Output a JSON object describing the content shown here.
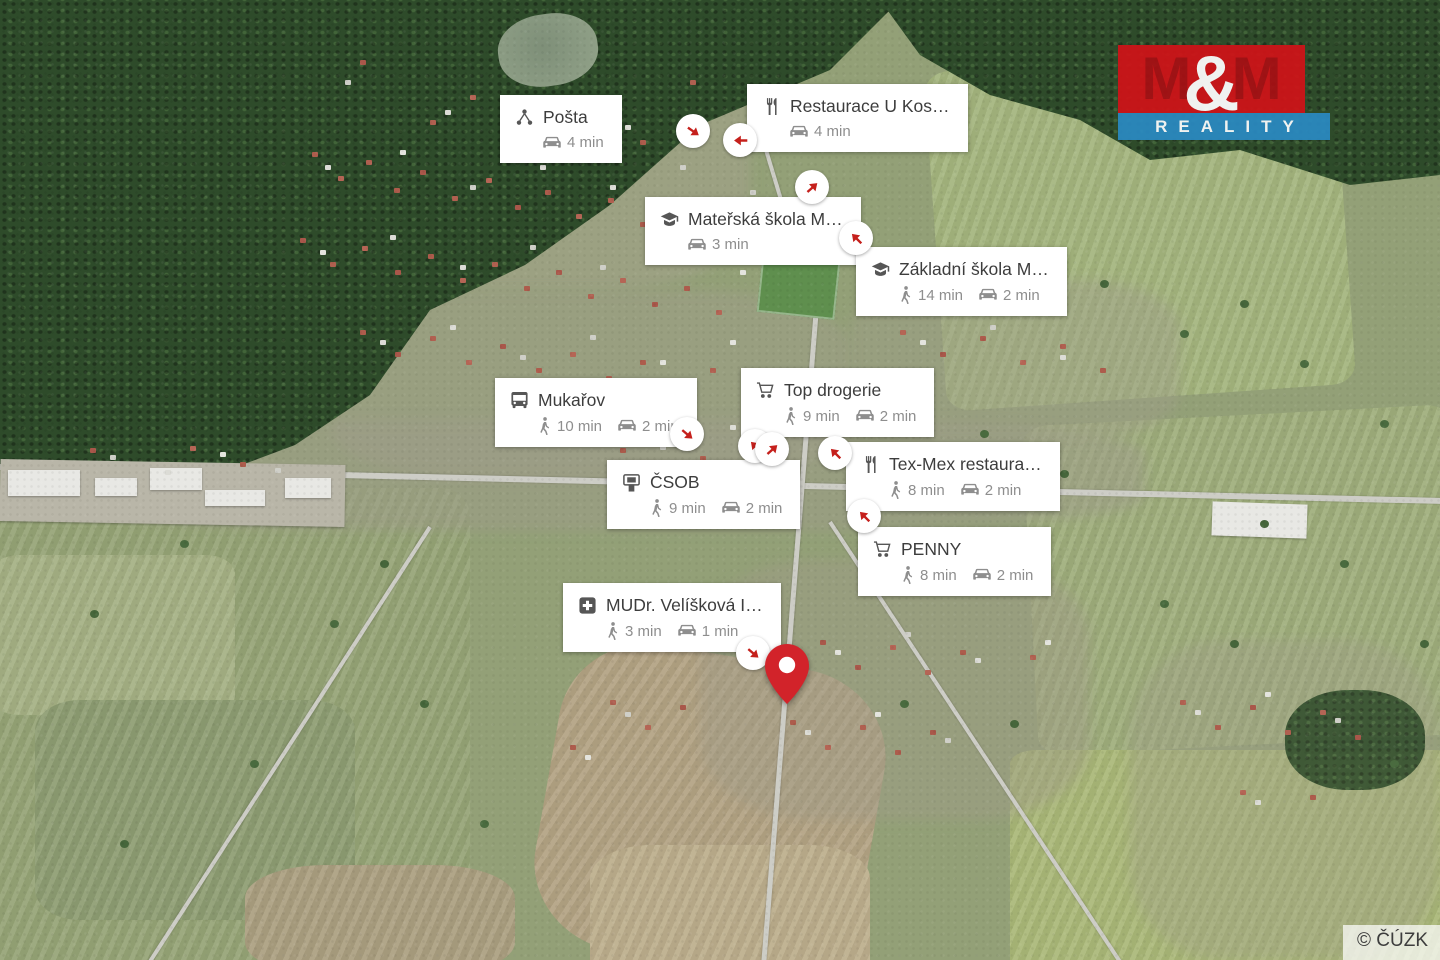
{
  "map": {
    "attribution": "© ČÚZK"
  },
  "logo": {
    "m1": "M",
    "amp": "&",
    "m2": "M",
    "reality": "REALITY"
  },
  "colors": {
    "marker_arrow_red": "#c5201c",
    "pin_red": "#d2232a",
    "logo_red": "#d01318",
    "logo_blue": "#2a8ac2"
  },
  "icons": {
    "walk": "walking-person-icon",
    "drive": "car-icon"
  },
  "pois": [
    {
      "title": "Pošta",
      "icon": "post-office-icon",
      "drive": "4 min"
    },
    {
      "title": "Restaurace U Kos…",
      "icon": "restaurant-icon",
      "drive": "4 min"
    },
    {
      "title": "Mateřská škola M…",
      "icon": "school-icon",
      "drive": "3 min"
    },
    {
      "title": "Základní škola M…",
      "icon": "school-icon",
      "walk": "14 min",
      "drive": "2 min"
    },
    {
      "title": "Mukařov",
      "icon": "bus-stop-icon",
      "walk": "10 min",
      "drive": "2 min"
    },
    {
      "title": "Top drogerie",
      "icon": "shopping-cart-icon",
      "walk": "9 min",
      "drive": "2 min"
    },
    {
      "title": "ČSOB",
      "icon": "atm-icon",
      "walk": "9 min",
      "drive": "2 min"
    },
    {
      "title": "Tex-Mex restaura…",
      "icon": "restaurant-icon",
      "walk": "8 min",
      "drive": "2 min"
    },
    {
      "title": "PENNY",
      "icon": "shopping-cart-icon",
      "walk": "8 min",
      "drive": "2 min"
    },
    {
      "title": "MUDr. Velíšková I…",
      "icon": "doctor-icon",
      "walk": "3 min",
      "drive": "1 min"
    }
  ],
  "markers": [
    {
      "for": "Pošta",
      "direction": "southeast"
    },
    {
      "for": "Restaurace U Kos…",
      "direction": "west"
    },
    {
      "for": "Mateřská škola M…",
      "direction": "northeast"
    },
    {
      "for": "Základní škola M…",
      "direction": "northwest"
    },
    {
      "for": "Mukařov",
      "direction": "southeast"
    },
    {
      "for": "Top drogerie",
      "direction": "northwest"
    },
    {
      "for": "ČSOB",
      "direction": "northeast"
    },
    {
      "for": "Tex-Mex restaura…",
      "direction": "northwest"
    },
    {
      "for": "PENNY",
      "direction": "northwest"
    },
    {
      "for": "MUDr. Velíšková I…",
      "direction": "southeast"
    }
  ]
}
